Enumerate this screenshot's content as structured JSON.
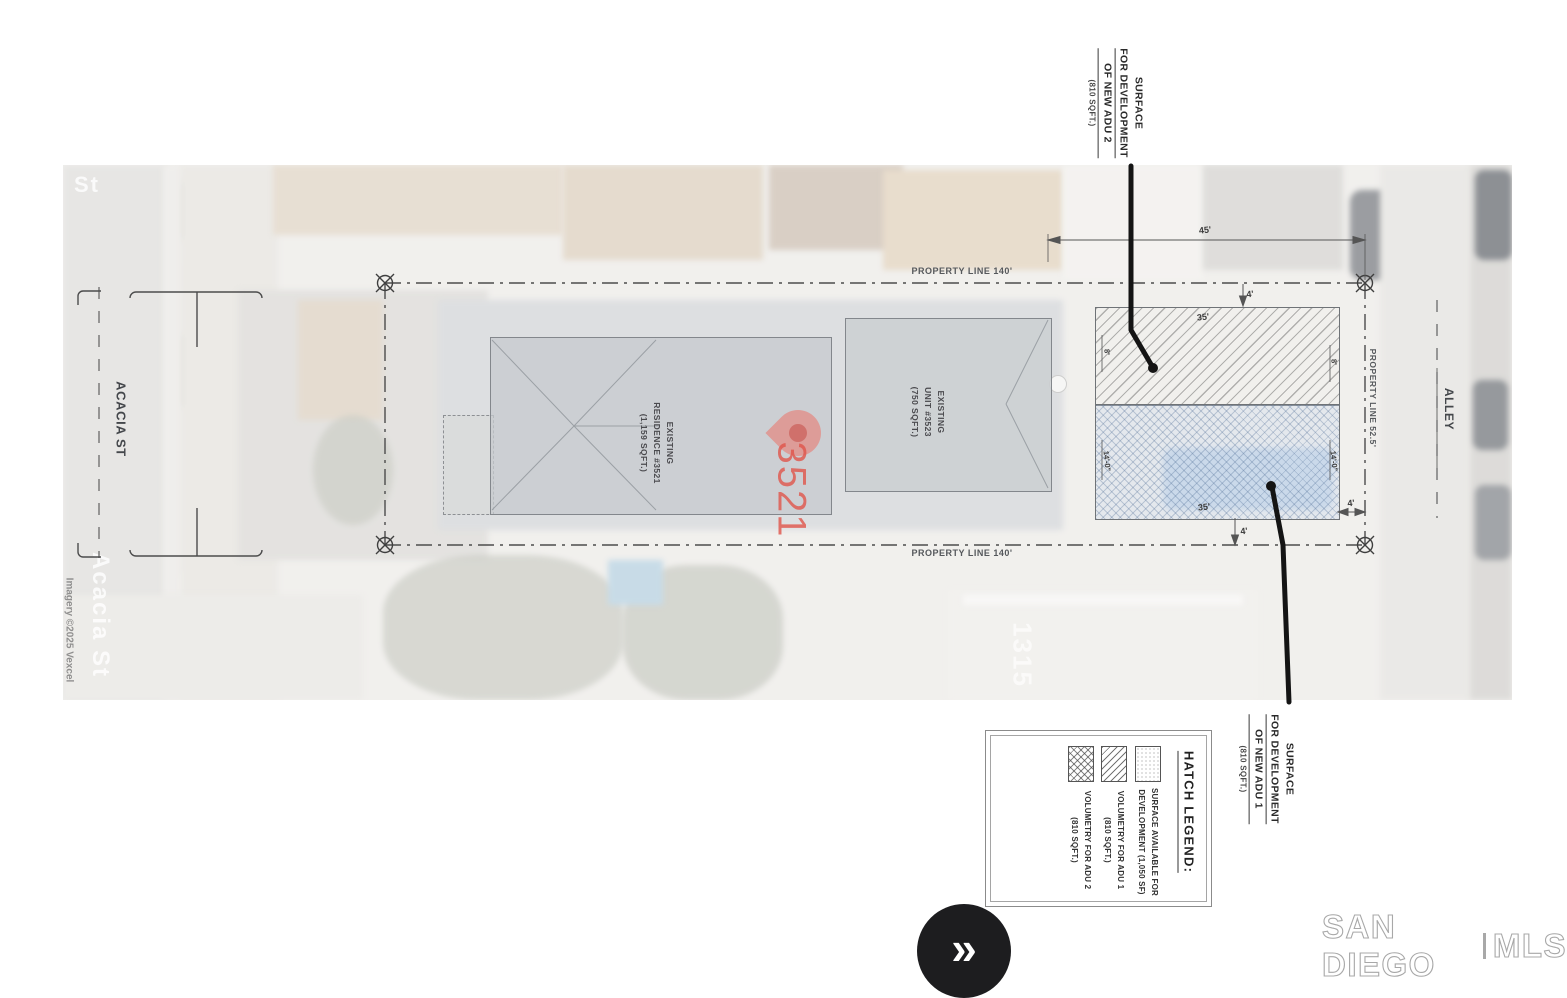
{
  "photo": {
    "street_name_watermark": "Acacia St",
    "street_name_top": "St",
    "imagery_credit": "Imagery ©2025 Vexcel",
    "house_number": "1315"
  },
  "plan": {
    "street_label": "ACACIA ST",
    "alley_label": "ALLEY",
    "property_line_top": "PROPERTY LINE 140'",
    "property_line_bottom": "PROPERTY LINE 140'",
    "property_line_right": "PROPERTY LINE 52.5'",
    "residence": {
      "l1": "EXISTING",
      "l2": "RESIDENCE #3521",
      "l3": "(1,159 SQFT.)"
    },
    "unit": {
      "l1": "EXISTING",
      "l2": "UNIT #3523",
      "l3": "(750 SQFT.)"
    },
    "pin_number": "3521",
    "callout_adu2": {
      "l1": "SURFACE",
      "l2": "FOR DEVELOPMENT",
      "l3": "OF NEW ADU 2",
      "l4": "(810 SQFT.)"
    },
    "callout_adu1": {
      "l1": "SURFACE",
      "l2": "FOR DEVELOPMENT",
      "l3": "OF NEW ADU 1",
      "l4": "(810 SQFT.)"
    },
    "dims": {
      "top_width": "45'",
      "adu_width_top": "35'",
      "adu_width_bottom": "35'",
      "setback_top": "4'",
      "setback_bottom": "4'",
      "setback_right": "4'",
      "side_upper_left": "8'",
      "side_upper_right": "8'",
      "side_lower_left": "14'-0\"",
      "side_lower_right": "14'-0\""
    }
  },
  "legend": {
    "title": "HATCH LEGEND:",
    "entries": [
      {
        "line1": "SURFACE AVAILABLE FOR",
        "line2": "DEVELOPMENT (1,050 SF)"
      },
      {
        "line1": "VOLUMETRY FOR ADU 1",
        "line2": "(810 SQFT.)"
      },
      {
        "line1": "VOLUMETRY FOR ADU 2",
        "line2": "(810 SQFT.)"
      }
    ]
  },
  "viewer": {
    "next_button_glyph": "»"
  },
  "branding": {
    "left": "SAN DIEGO",
    "right": "MLS"
  },
  "colors": {
    "pin": "#ee7064",
    "hatch_blue": "#a9c4e0",
    "leader": "#141414",
    "brand_gray": "#a8a8a8"
  }
}
